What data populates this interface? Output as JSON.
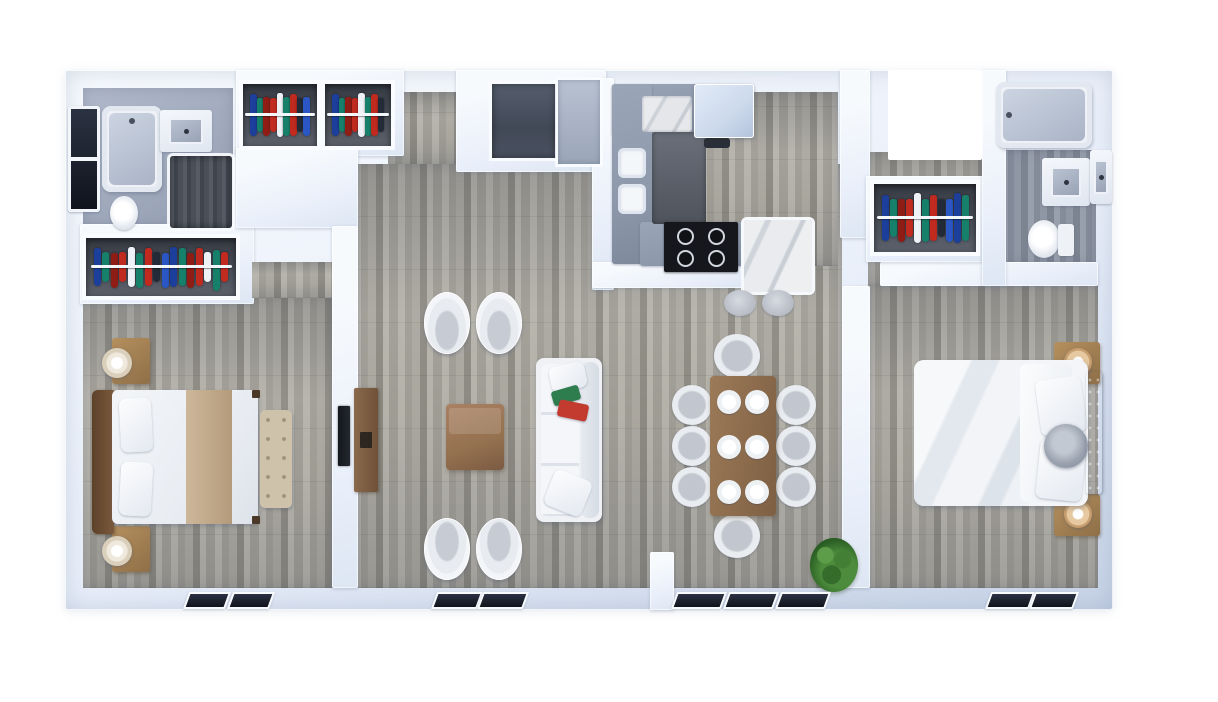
{
  "palette": {
    "background": "#ffffff",
    "wall_light": "#f7fafd",
    "wall": "#e9effa",
    "wall_shadow": "#c6d2e6",
    "wood_a": "#b3b0a8",
    "wood_b": "#9d9a92",
    "wood_c": "#8a877f",
    "wood_d": "#a8a59d",
    "bath_floor_a": "#b0b9ca",
    "bath_floor_b": "#939db1",
    "closet_dark": "#363a43",
    "closet_mid": "#5c616b",
    "rod_white": "#f3f6fa",
    "cabinet": "#8e99ac",
    "fridge": "#ccd9ec",
    "cooktop": "#15171c",
    "burner_ring": "#d2d6dd",
    "window_pane_a": "#2b3242",
    "window_pane_b": "#10131c",
    "sofa_white": "#eff1f5",
    "chair_gray": "#c7cbd3",
    "bed_white": "#f3f5f8",
    "bed_shade": "#dde2ea",
    "runner_tan": "#c1a98b",
    "wood_brown": "#94714f",
    "wood_brown_dark": "#6f5138",
    "bench": "#cec2ab",
    "lamp_tan": "#c79d6e",
    "plant_a": "#4c8c3c",
    "plant_b": "#2b5f24"
  },
  "closets": {
    "garment_colors": [
      "#1d3f9c",
      "#17806a",
      "#8f1d16",
      "#c02a1f",
      "#eef1f5",
      "#17806a",
      "#c02a1f",
      "#232b38",
      "#2a57c4"
    ],
    "units": [
      {
        "id": "closet-a",
        "garments": 9
      },
      {
        "id": "closet-b",
        "garments": 8
      },
      {
        "id": "closet-bedroom-left",
        "garments": 16
      },
      {
        "id": "closet-hall-right",
        "garments": 11
      }
    ]
  },
  "scene": {
    "view": "top-down 3d render of a two-bedroom apartment floor plan, no text labels",
    "rooms": [
      {
        "name": "bathroom-left",
        "features": [
          "dark-window",
          "bathtub",
          "vanity-sink",
          "dark-shower-area",
          "toilet"
        ]
      },
      {
        "name": "closet-a",
        "features": [
          "hanging-clothes"
        ]
      },
      {
        "name": "closet-b",
        "features": [
          "hanging-clothes"
        ]
      },
      {
        "name": "entry",
        "features": [
          "dark-floor-alcove",
          "gray-alcove"
        ]
      },
      {
        "name": "kitchen",
        "features": [
          "u-shaped-gray-cabinets",
          "marble-counter",
          "double-sink",
          "refrigerator",
          "cooktop-4-burners",
          "marble-island",
          "two-bar-stools"
        ]
      },
      {
        "name": "living-room",
        "features": [
          "four-white-armchairs",
          "wood-coffee-table",
          "white-sofa",
          "green-throw",
          "red-throw",
          "tv",
          "tv-console",
          "two-windows"
        ]
      },
      {
        "name": "dining-area",
        "features": [
          "wood-table",
          "six-place-settings",
          "eight-chairs",
          "potted-plant",
          "three-windows"
        ]
      },
      {
        "name": "bedroom-left",
        "features": [
          "wide-closet-with-clothes",
          "double-bed",
          "tan-runner",
          "wood-headboard",
          "two-nightstands",
          "two-lamps",
          "foot-bench",
          "two-windows"
        ]
      },
      {
        "name": "hallway-right",
        "features": [
          "closet-with-clothes"
        ]
      },
      {
        "name": "bathroom-right",
        "features": [
          "bathtub",
          "vanity-sink",
          "mirror-cabinet",
          "toilet"
        ]
      },
      {
        "name": "bedroom-right",
        "features": [
          "double-bed-white-duvet",
          "gray-tufted-headboard",
          "round-cushion",
          "two-nightstands",
          "two-lamps",
          "two-windows"
        ]
      }
    ],
    "dining": {
      "place_settings": 6,
      "chairs": 8
    },
    "living": {
      "armchairs": 4
    },
    "bottom_window_groups": [
      2,
      2,
      3,
      2
    ]
  }
}
